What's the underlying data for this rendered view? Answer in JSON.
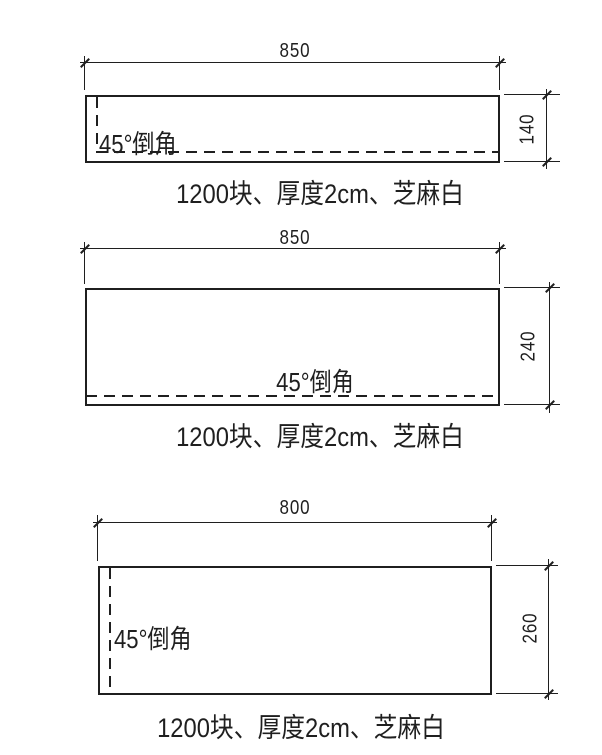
{
  "drawing": {
    "background_color": "#ffffff",
    "line_color": "#1f1f1f",
    "panels": [
      {
        "name": "panel-1",
        "width_label": "850",
        "height_label": "140",
        "chamfer_label": "45°倒角",
        "chamfer_edges": "left,bottom",
        "caption": "1200块、厚度2cm、芝麻白"
      },
      {
        "name": "panel-2",
        "width_label": "850",
        "height_label": "240",
        "chamfer_label": "45°倒角",
        "chamfer_edges": "bottom",
        "caption": "1200块、厚度2cm、芝麻白"
      },
      {
        "name": "panel-3",
        "width_label": "800",
        "height_label": "260",
        "chamfer_label": "45°倒角",
        "chamfer_edges": "left",
        "caption": "1200块、厚度2cm、芝麻白"
      }
    ]
  }
}
